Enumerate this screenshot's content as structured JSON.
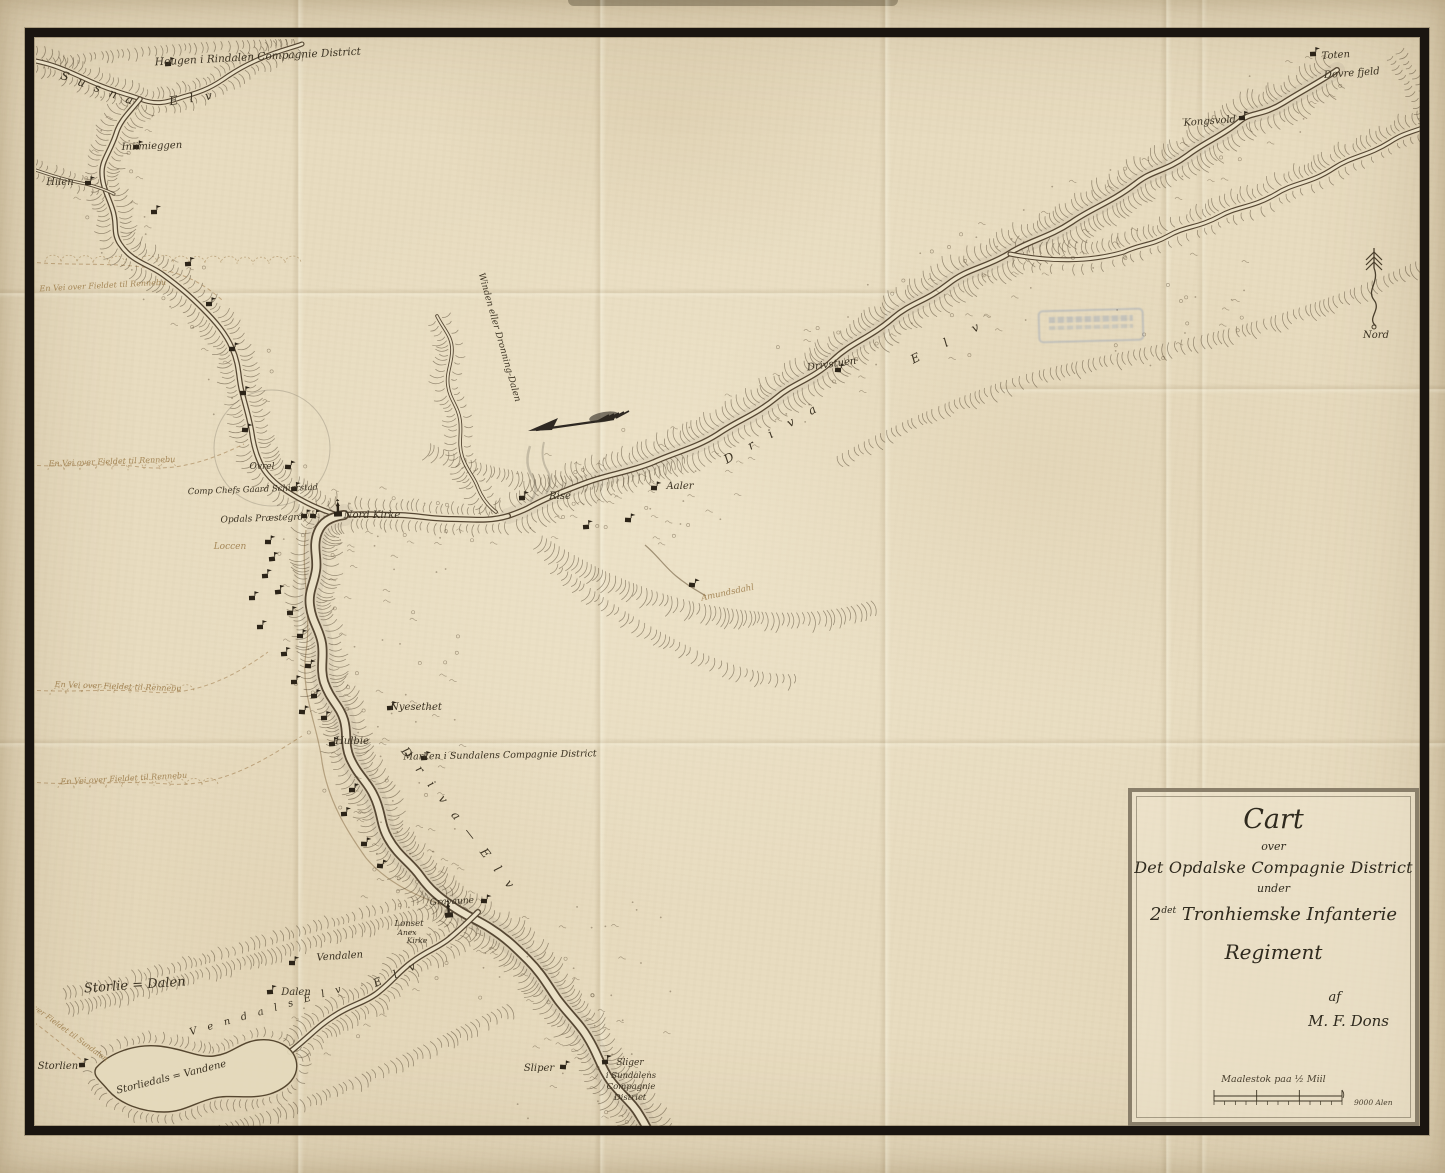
{
  "cartouche": {
    "line1": "Cart",
    "line2": "over",
    "line3": "Det Opdalske Compagnie District",
    "line4": "under",
    "line5_num": "2",
    "line5_sup": "det",
    "line5_rest": " Tronhiemske Infanterie",
    "line6": "Regiment",
    "line7": "af",
    "line8": "M. F. Dons",
    "scale_caption": "Maalestok paa ½ Miil",
    "scale_unit": "9000 Alen"
  },
  "compass": {
    "label": "Nord"
  },
  "colors": {
    "paper": "#e8dcc0",
    "ink": "#3b3222",
    "faded_ink": "#9a7946",
    "frame": "#1a1510",
    "stamp_blue": "#6482b4"
  },
  "labels": [
    {
      "t": "Hougen i Rindalen Compagnie District",
      "x": 258,
      "y": 60,
      "r": -3,
      "s": 10.5
    },
    {
      "t": "S u s n a",
      "x": 97,
      "y": 92,
      "r": 20,
      "s": 12,
      "ls": 3
    },
    {
      "t": "E l v",
      "x": 193,
      "y": 102,
      "r": -8,
      "s": 12,
      "ls": 4
    },
    {
      "t": "Iniimieggen",
      "x": 152,
      "y": 149,
      "r": -2,
      "s": 10
    },
    {
      "t": "Hiien",
      "x": 60,
      "y": 185,
      "r": 0,
      "s": 10
    },
    {
      "t": "Toten",
      "x": 1336,
      "y": 58,
      "r": -4,
      "s": 10
    },
    {
      "t": "Dovre fjeld",
      "x": 1352,
      "y": 76,
      "r": -4,
      "s": 10
    },
    {
      "t": "Kongsvold",
      "x": 1210,
      "y": 124,
      "r": -4,
      "s": 10
    },
    {
      "t": "Drivstuen",
      "x": 832,
      "y": 367,
      "r": -8,
      "s": 10
    },
    {
      "t": "E l v",
      "x": 952,
      "y": 344,
      "r": -27,
      "s": 12,
      "ls": 12
    },
    {
      "t": "D r i v a",
      "x": 775,
      "y": 436,
      "r": -30,
      "s": 12,
      "ls": 7
    },
    {
      "t": "Winden eller Dronning-Dalen",
      "x": 497,
      "y": 338,
      "r": 74,
      "s": 9
    },
    {
      "t": "Rise",
      "x": 560,
      "y": 499,
      "r": 0,
      "s": 10
    },
    {
      "t": "Aaler",
      "x": 680,
      "y": 489,
      "r": 0,
      "s": 10
    },
    {
      "t": "Amundsdahl",
      "x": 728,
      "y": 595,
      "r": -12,
      "s": 8.5,
      "c": "faded"
    },
    {
      "t": "Comp Chefs Gaard Schierstad",
      "x": 253,
      "y": 492,
      "r": -2,
      "s": 8.5
    },
    {
      "t": "Opdals Præstegrd",
      "x": 262,
      "y": 521,
      "r": -2,
      "s": 9
    },
    {
      "t": "Nord Kirke",
      "x": 372,
      "y": 518,
      "r": 0,
      "s": 10
    },
    {
      "t": "Loccen",
      "x": 230,
      "y": 549,
      "r": 0,
      "s": 9,
      "c": "faded"
    },
    {
      "t": "Ovrel",
      "x": 262,
      "y": 469,
      "r": 0,
      "s": 9
    },
    {
      "t": "Hulbie",
      "x": 352,
      "y": 744,
      "r": 0,
      "s": 10
    },
    {
      "t": "Nyesethet",
      "x": 416,
      "y": 710,
      "r": 0,
      "s": 10
    },
    {
      "t": "Marken i Sundalens Compagnie District",
      "x": 500,
      "y": 758,
      "r": -1,
      "s": 9.5
    },
    {
      "t": "D r i v a — E l v",
      "x": 456,
      "y": 822,
      "r": 52,
      "s": 12,
      "ls": 5
    },
    {
      "t": "Storlie = Dalen",
      "x": 135,
      "y": 989,
      "r": -4,
      "s": 13
    },
    {
      "t": "Storlien",
      "x": 58,
      "y": 1069,
      "r": 0,
      "s": 10
    },
    {
      "t": "Storliedals = Vandene",
      "x": 172,
      "y": 1080,
      "r": -14,
      "s": 10
    },
    {
      "t": "Dalen",
      "x": 296,
      "y": 995,
      "r": 0,
      "s": 10
    },
    {
      "t": "Vendalen",
      "x": 340,
      "y": 959,
      "r": -4,
      "s": 10
    },
    {
      "t": "Lønset",
      "x": 409,
      "y": 926,
      "r": 0,
      "s": 8.5
    },
    {
      "t": "Anex",
      "x": 407,
      "y": 935,
      "r": 0,
      "s": 7.5
    },
    {
      "t": "Kirke",
      "x": 417,
      "y": 943,
      "r": 0,
      "s": 7.5
    },
    {
      "t": "Gravaune",
      "x": 452,
      "y": 904,
      "r": -3,
      "s": 9
    },
    {
      "t": "Sliper",
      "x": 539,
      "y": 1071,
      "r": 0,
      "s": 10
    },
    {
      "t": "Sliger",
      "x": 630,
      "y": 1065,
      "r": 0,
      "s": 9
    },
    {
      "t": "i Sundalens",
      "x": 631,
      "y": 1078,
      "r": 0,
      "s": 8.5
    },
    {
      "t": "Compagnie",
      "x": 631,
      "y": 1089,
      "r": 0,
      "s": 8.5
    },
    {
      "t": "District",
      "x": 630,
      "y": 1100,
      "r": 0,
      "s": 8.5
    },
    {
      "t": "E l v",
      "x": 398,
      "y": 977,
      "r": -24,
      "s": 11,
      "ls": 5
    },
    {
      "t": "V e n d a l s   E l v",
      "x": 268,
      "y": 1013,
      "r": -16,
      "s": 10,
      "ls": 4
    },
    {
      "t": "En Vei over Fieldet til Rennebu",
      "x": 103,
      "y": 288,
      "r": -3,
      "s": 8,
      "c": "faded"
    },
    {
      "t": "En Vei over Fieldet til Rennebu",
      "x": 112,
      "y": 464,
      "r": -2,
      "s": 8,
      "c": "faded"
    },
    {
      "t": "En Vei over Fieldet til Rennebu",
      "x": 118,
      "y": 689,
      "r": 2,
      "s": 8,
      "c": "faded"
    },
    {
      "t": "En Vei over Fieldet til Rennebu",
      "x": 124,
      "y": 781,
      "r": -3,
      "s": 8,
      "c": "faded"
    },
    {
      "t": "Vei over Fieldet til Sundalen",
      "x": 62,
      "y": 1030,
      "r": 36,
      "s": 7.5,
      "c": "faded"
    }
  ],
  "symbols": [
    {
      "x": 168,
      "y": 64
    },
    {
      "x": 136,
      "y": 147
    },
    {
      "x": 88,
      "y": 183
    },
    {
      "x": 154,
      "y": 212
    },
    {
      "x": 188,
      "y": 264
    },
    {
      "x": 209,
      "y": 304
    },
    {
      "x": 232,
      "y": 349
    },
    {
      "x": 243,
      "y": 393
    },
    {
      "x": 245,
      "y": 430
    },
    {
      "x": 288,
      "y": 467
    },
    {
      "x": 294,
      "y": 489
    },
    {
      "x": 304,
      "y": 516
    },
    {
      "x": 313,
      "y": 516
    },
    {
      "x": 338,
      "y": 514,
      "t": "c"
    },
    {
      "x": 268,
      "y": 542
    },
    {
      "x": 272,
      "y": 559
    },
    {
      "x": 265,
      "y": 576
    },
    {
      "x": 278,
      "y": 592
    },
    {
      "x": 252,
      "y": 598
    },
    {
      "x": 290,
      "y": 613
    },
    {
      "x": 260,
      "y": 627
    },
    {
      "x": 300,
      "y": 636
    },
    {
      "x": 284,
      "y": 654
    },
    {
      "x": 308,
      "y": 666
    },
    {
      "x": 294,
      "y": 682
    },
    {
      "x": 314,
      "y": 696
    },
    {
      "x": 302,
      "y": 712
    },
    {
      "x": 324,
      "y": 718
    },
    {
      "x": 332,
      "y": 744
    },
    {
      "x": 390,
      "y": 708
    },
    {
      "x": 424,
      "y": 758
    },
    {
      "x": 352,
      "y": 790
    },
    {
      "x": 344,
      "y": 814
    },
    {
      "x": 364,
      "y": 844
    },
    {
      "x": 380,
      "y": 866
    },
    {
      "x": 292,
      "y": 963
    },
    {
      "x": 270,
      "y": 992
    },
    {
      "x": 82,
      "y": 1065
    },
    {
      "x": 449,
      "y": 915,
      "t": "c"
    },
    {
      "x": 484,
      "y": 901
    },
    {
      "x": 563,
      "y": 1067
    },
    {
      "x": 605,
      "y": 1062
    },
    {
      "x": 522,
      "y": 498
    },
    {
      "x": 654,
      "y": 488
    },
    {
      "x": 838,
      "y": 370
    },
    {
      "x": 1242,
      "y": 118
    },
    {
      "x": 1313,
      "y": 54
    },
    {
      "x": 692,
      "y": 585
    },
    {
      "x": 586,
      "y": 527
    },
    {
      "x": 628,
      "y": 520
    }
  ]
}
